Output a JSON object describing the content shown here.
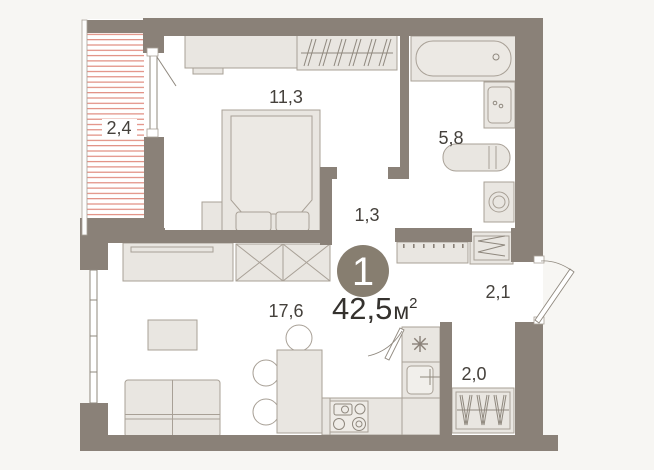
{
  "plan": {
    "badge": {
      "rooms_count": "1"
    },
    "total_area": {
      "value": "42,5",
      "unit": "м",
      "sup": "2"
    },
    "rooms": [
      {
        "name": "balcony",
        "area": "2,4"
      },
      {
        "name": "bedroom",
        "area": "11,3"
      },
      {
        "name": "bathroom",
        "area": "5,8"
      },
      {
        "name": "hallway",
        "area": "1,3"
      },
      {
        "name": "living-kitchen",
        "area": "17,6"
      },
      {
        "name": "entry-hall",
        "area": "2,1"
      },
      {
        "name": "closet",
        "area": "2,0"
      }
    ],
    "colors": {
      "wall": "#8a8178",
      "floor": "#ffffff",
      "background": "#f7f6f3",
      "furniture": "#e9e6e1",
      "furniture_stroke": "#a8a096",
      "balcony_hatch": "#de8173",
      "badge": "#877e70",
      "text": "#45413c"
    }
  }
}
